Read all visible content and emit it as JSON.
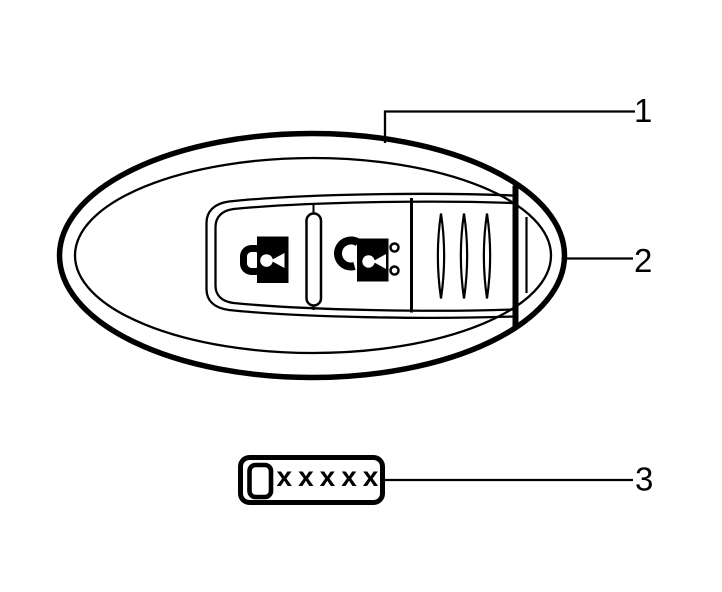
{
  "canvas": {
    "width": 722,
    "height": 592,
    "background": "#ffffff",
    "line_color": "#000000"
  },
  "diagram": {
    "subject": "key-fob-transmitter-line-art",
    "callouts": [
      {
        "number": "1"
      },
      {
        "number": "2"
      },
      {
        "number": "3"
      }
    ],
    "label_box": {
      "text": "xxxxx"
    },
    "icons": {
      "lock": "lock-icon",
      "unlock": "unlock-icon",
      "chip": "chip-outline-icon"
    },
    "counts": {
      "grip_ridges": 3,
      "indicator_dots": 2
    }
  }
}
